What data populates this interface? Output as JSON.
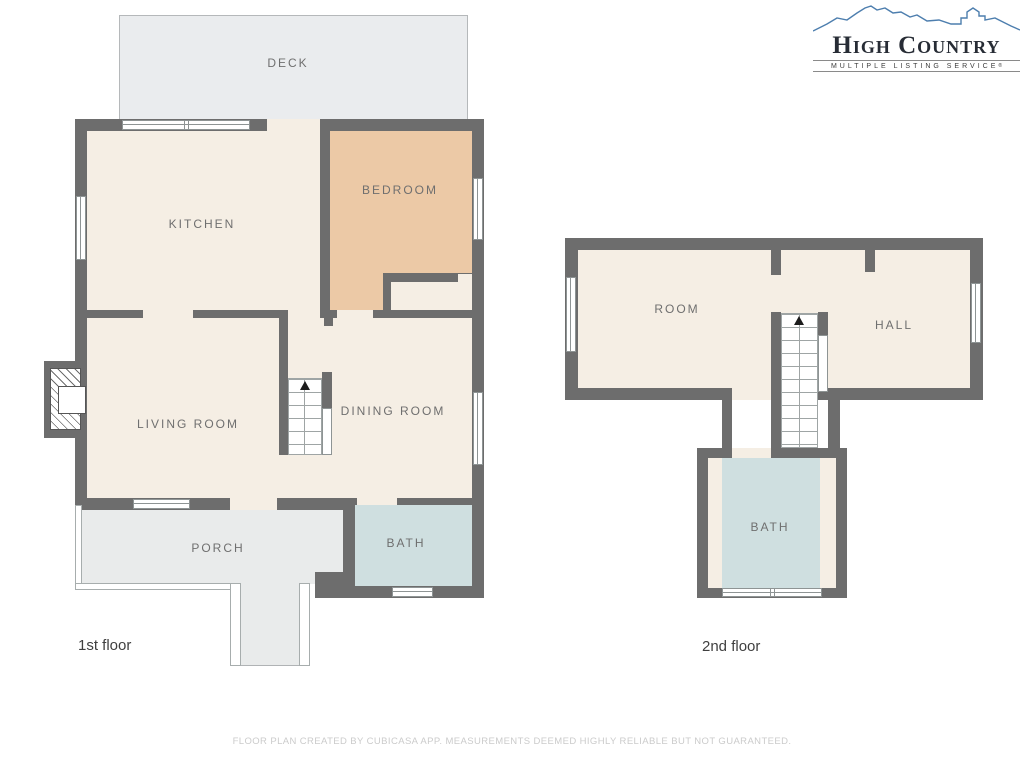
{
  "header": {
    "logo": {
      "title": "High Country",
      "subtitle": "MULTIPLE LISTING SERVICE",
      "registered": "®"
    }
  },
  "floor_plan": {
    "first_floor": {
      "label": "1st floor",
      "rooms": {
        "deck": "DECK",
        "kitchen": "KITCHEN",
        "bedroom": "BEDROOM",
        "living_room": "LIVING ROOM",
        "dining_room": "DINING ROOM",
        "porch": "PORCH",
        "bath": "BATH"
      }
    },
    "second_floor": {
      "label": "2nd floor",
      "rooms": {
        "room": "ROOM",
        "hall": "HALL",
        "bath": "BATH"
      }
    }
  },
  "footer": {
    "disclaimer": "FLOOR PLAN CREATED BY CUBICASA APP. MEASUREMENTS DEEMED HIGHLY RELIABLE BUT NOT GUARANTEED."
  },
  "colors": {
    "wall": "#6d6d6d",
    "room_fill": "#f5eee4",
    "bedroom_fill": "#ecc9a6",
    "bath_fill": "#cfdfe0",
    "deck_fill": "#eaecee",
    "porch_fill": "#e9ebeb",
    "label_text": "#6f6f6f",
    "logo_mountain": "#4d7eae"
  }
}
